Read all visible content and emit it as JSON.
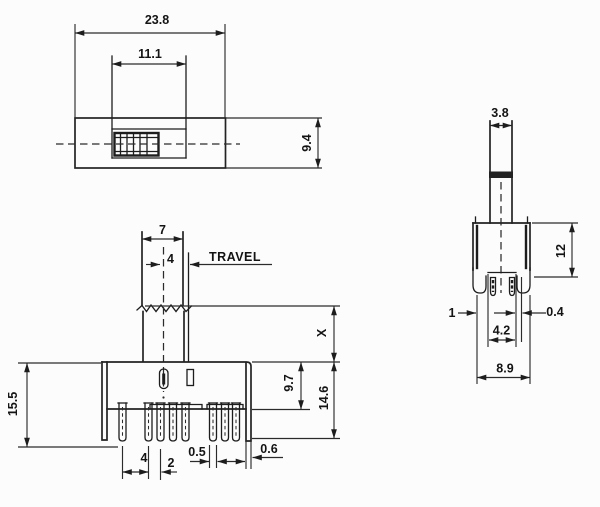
{
  "drawing": {
    "kind": "engineering-dimension-drawing",
    "component": "slide-switch",
    "top_view": {
      "overall_width": "23.8",
      "slot_width": "11.1",
      "body_depth": "9.4"
    },
    "front_view": {
      "knob_width": "7",
      "center_offset": "4",
      "travel_label": "TRAVEL",
      "stem_height": "X",
      "overall_height": "15.5",
      "body_height": "9.7",
      "height_with_pins": "14.6",
      "pin_pitch_a": "4",
      "pin_pitch_b": "2",
      "pin_width": "0.5",
      "wall_thickness": "0.6"
    },
    "side_view": {
      "stem_width": "3.8",
      "body_height": "12",
      "foot_width": "1",
      "pin_offset": "0.4",
      "channel_width": "4.2",
      "body_width": "8.9"
    }
  }
}
